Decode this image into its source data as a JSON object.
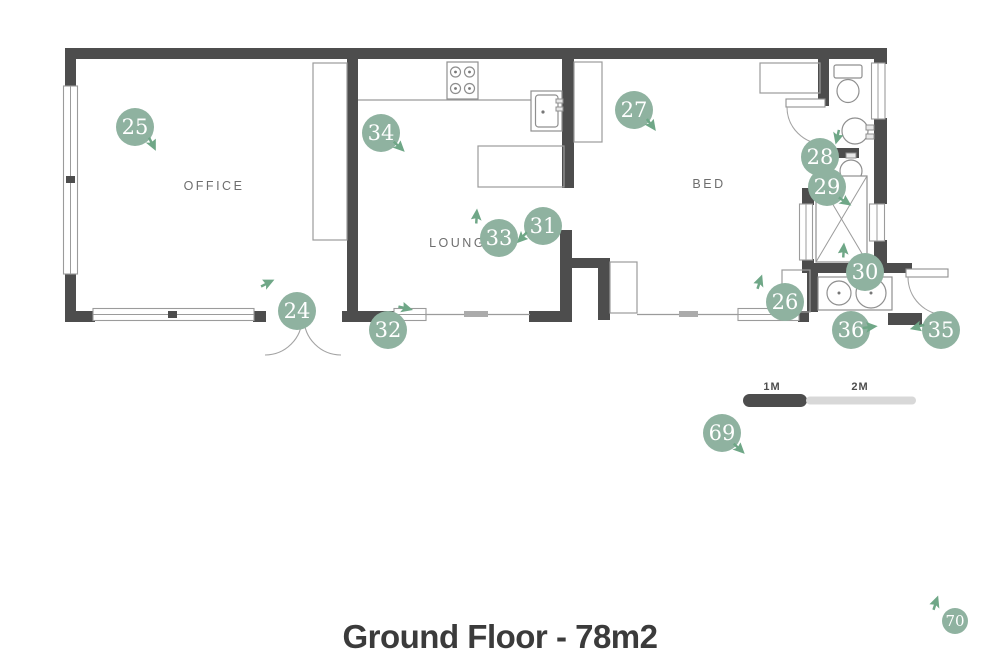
{
  "title": "Ground Floor - 78m2",
  "room_labels": {
    "office": "OFFICE",
    "lounge": "LOUNGE",
    "bed": "BED"
  },
  "scale_bar": {
    "label_1m": "1M",
    "label_2m": "2M"
  },
  "colors": {
    "marker_green": "#8fb2a0",
    "arrow_green": "#6fa787",
    "wall_dark": "#4d4d4d",
    "line_gray": "#9b9b9b",
    "scale_light": "#d8d8d8",
    "title_text": "#3b3b3b",
    "room_label_text": "#6e6e6e"
  },
  "markers": [
    {
      "number": "24",
      "x": 297,
      "y": 311,
      "r": 19,
      "arrow": {
        "x": 268,
        "y": 284,
        "angle": 90
      }
    },
    {
      "number": "25",
      "x": 135,
      "y": 127,
      "r": 19,
      "arrow": {
        "x": 151,
        "y": 144,
        "angle": 180
      }
    },
    {
      "number": "26",
      "x": 785,
      "y": 302,
      "r": 19,
      "arrow": {
        "x": 761,
        "y": 282,
        "angle": 45
      }
    },
    {
      "number": "27",
      "x": 634,
      "y": 110,
      "r": 19,
      "arrow": {
        "x": 650,
        "y": 125,
        "angle": 170
      }
    },
    {
      "number": "28",
      "x": 820,
      "y": 157,
      "r": 19,
      "arrow": {
        "x": 836,
        "y": 136,
        "angle": 220
      }
    },
    {
      "number": "29",
      "x": 827,
      "y": 187,
      "r": 19,
      "arrow": {
        "x": 844,
        "y": 202,
        "angle": 150
      }
    },
    {
      "number": "30",
      "x": 865,
      "y": 272,
      "r": 19,
      "arrow": {
        "x": 845,
        "y": 250,
        "angle": 30
      }
    },
    {
      "number": "31",
      "x": 543,
      "y": 226,
      "r": 19,
      "arrow": {
        "x": 521,
        "y": 236,
        "angle": 250
      }
    },
    {
      "number": "32",
      "x": 388,
      "y": 330,
      "r": 19,
      "arrow": {
        "x": 405,
        "y": 309,
        "angle": 130
      }
    },
    {
      "number": "33",
      "x": 499,
      "y": 238,
      "r": 19,
      "arrow": {
        "x": 478,
        "y": 216,
        "angle": 30
      }
    },
    {
      "number": "34",
      "x": 381,
      "y": 133,
      "r": 19,
      "arrow": {
        "x": 398,
        "y": 147,
        "angle": 160
      }
    },
    {
      "number": "35",
      "x": 941,
      "y": 330,
      "r": 19,
      "arrow": {
        "x": 917,
        "y": 325,
        "angle": 280
      }
    },
    {
      "number": "36",
      "x": 851,
      "y": 330,
      "r": 19,
      "arrow": {
        "x": 870,
        "y": 328,
        "angle": 110
      }
    },
    {
      "number": "69",
      "x": 722,
      "y": 433,
      "r": 19,
      "arrow": {
        "x": 738,
        "y": 449,
        "angle": 160
      }
    },
    {
      "number": "70",
      "x": 955,
      "y": 621,
      "r": 13,
      "arrow": {
        "x": 937,
        "y": 603,
        "angle": 45
      }
    }
  ]
}
